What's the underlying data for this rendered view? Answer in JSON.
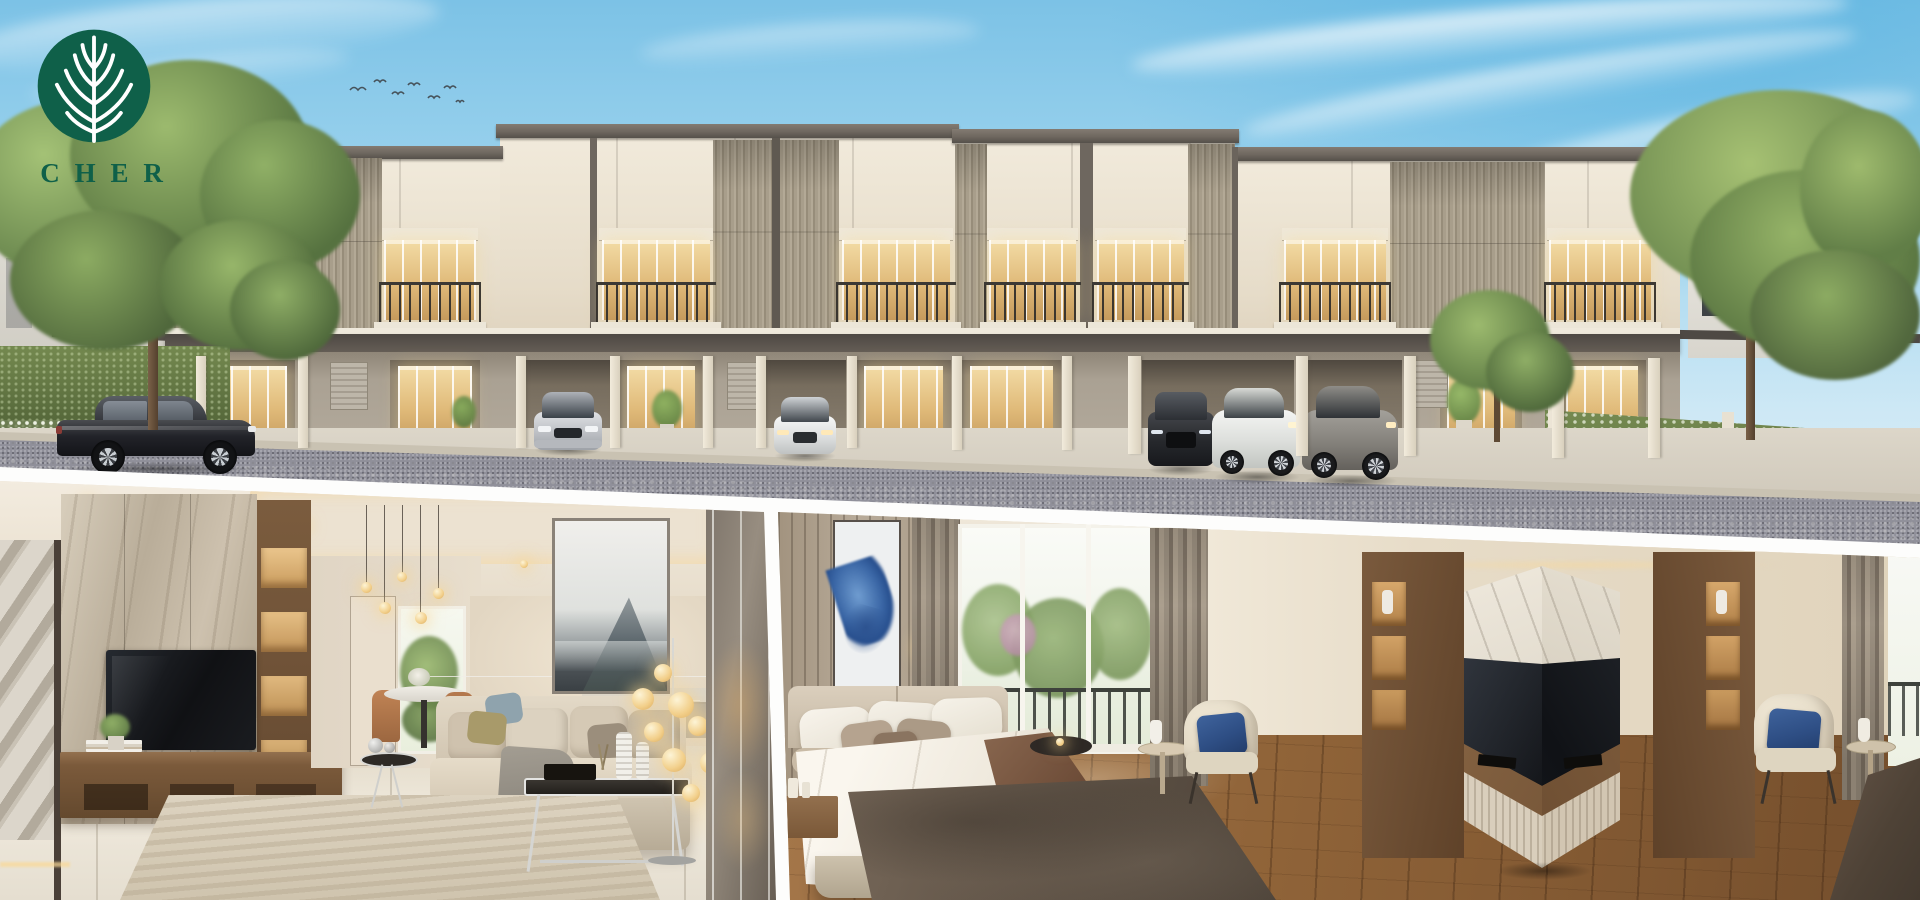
{
  "meta": {
    "canvas_width": 1920,
    "canvas_height": 900,
    "media_type": "real-estate marketing collage render"
  },
  "brand": {
    "wordmark": "CHER",
    "logo_icon": "leaf-tree-circle-icon",
    "logo_green": "#0f6049"
  },
  "sections": {
    "exterior": {
      "aria": "Render of a modern two-storey townhouse row at dusk: cream facades with grey slat panels, warm-lit windows and balconies, six luxury cars on the driveway and street, hedges and trees under a blue sky with birds"
    },
    "living_room": {
      "aria": "Living room render: travertine TV wall with walnut console, beige sofa with throw, chrome and glass coffee tables, golden globe floor lamps, ink-wash mountain artwork, mirror panelling, round dining table and garden door"
    },
    "bedroom": {
      "aria": "Bedroom render: upholstered bed with white duvet and brown runner, blue abstract artwork on slatted wall, balcony window with greenery, walnut corner TV feature wall with marble chevron, and cream armchairs with navy pillows"
    }
  },
  "palette": {
    "sky_top": "#7cc2e6",
    "sky_horizon": "#e8f3f9",
    "facade_cream": "#ece4d3",
    "facade_slat": "#a69d8e",
    "fascia_dark": "#6e675f",
    "canopy_dark": "#55504a",
    "window_warm": "#ecc887",
    "railing_dark": "#3c3934",
    "road_asphalt": "#90909a",
    "driveway_concrete": "#d7d1c4",
    "hedge_green": "#5f7544",
    "tree_green": "#7ca25b",
    "mat_white": "#fdfdfc",
    "interior_cream": "#e9dfcd",
    "marble_beige": "#c3b7a2",
    "walnut_wood": "#6f5138",
    "floor_wood": "#8a5f38",
    "sofa_beige": "#d8cdba",
    "lamp_glow": "#f2cf8a",
    "art_blue": "#3b67a6",
    "pillow_navy": "#2e4e84",
    "runner_brown": "#6b4a36",
    "street_car_black": "#222329",
    "car_silver": "#c9cbce",
    "car_white": "#eceeef",
    "car_grey": "#8e8b86"
  },
  "objects": {
    "birds": {
      "count": 7
    },
    "townhouse_units_visible": 8,
    "cars": [
      {
        "name": "street-sedan",
        "color": "charcoal black",
        "view": "side profile",
        "location": "street"
      },
      {
        "name": "garage-sedan-silver",
        "color": "silver",
        "view": "front",
        "location": "garage"
      },
      {
        "name": "garage-sedan-white",
        "color": "white",
        "view": "front",
        "location": "garage"
      },
      {
        "name": "garage-suv-charcoal",
        "color": "charcoal",
        "view": "front three-quarter",
        "location": "garage"
      },
      {
        "name": "garage-coupe-white",
        "color": "white",
        "view": "three-quarter",
        "location": "garage"
      },
      {
        "name": "garage-coupe-grey",
        "color": "grey",
        "view": "three-quarter",
        "location": "garage"
      }
    ]
  }
}
